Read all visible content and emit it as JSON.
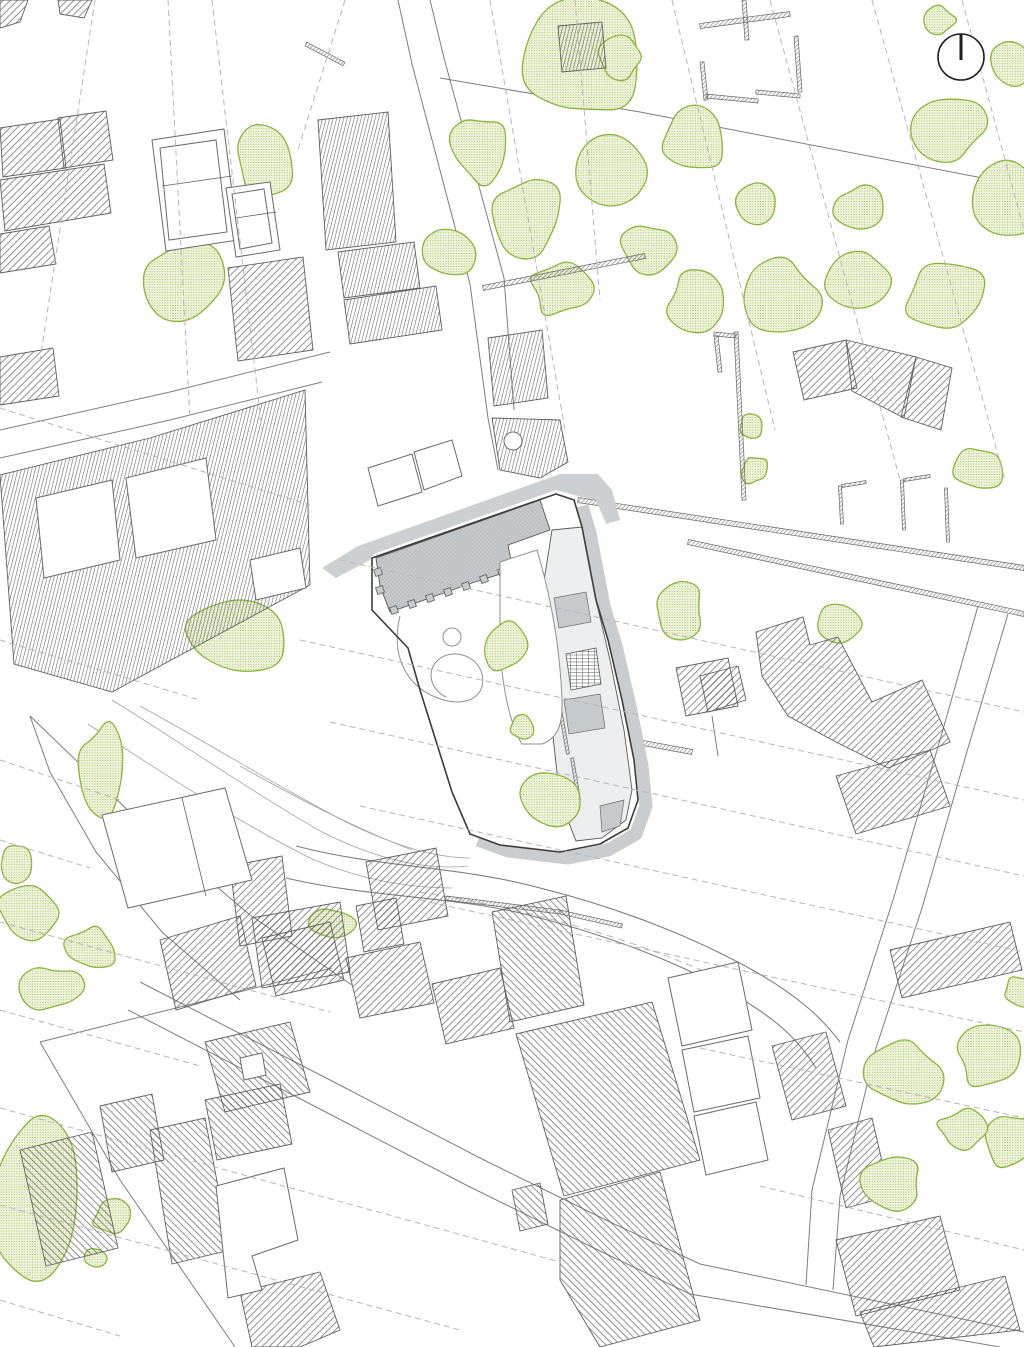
{
  "drawing": {
    "kind": "architectural-site-plan",
    "canvas": {
      "width": 1024,
      "height": 1347
    },
    "colors": {
      "line": "#5f5f5f",
      "outline": "#3c3c3c",
      "dash": "#b6b6b6",
      "parcel": "#7e7e7e",
      "terrain": "#a3a3a3",
      "greenline": "#8cb43d",
      "greendot": "#a6bf5e",
      "greenbg": "#eef3db",
      "plaza": "#ccd0d2",
      "shadow": "#c9cdcf",
      "paveb": "#c8ccce",
      "pavel": "#b2b6b8",
      "groom": "#c6cacc"
    },
    "north_arrow": {
      "icon": "north-arrow-icon",
      "cx": 961,
      "cy": 57,
      "r": 23
    },
    "contours_dashed": [
      "95,0 40,360",
      "168,0 190,420",
      "212,0 262,430",
      "345,0 298,150",
      "490,0 565,430",
      "575,0 600,300",
      "672,0 775,430",
      "770,0 900,480",
      "872,0 1005,480",
      "962,0 1024,230",
      "0,408 310,505",
      "0,640 200,700",
      "0,760 120,800",
      "0,840 90,868",
      "0,922 330,1012",
      "0,1010 200,1066",
      "0,1108 560,1262",
      "0,1205 460,1330",
      "0,1300 120,1336",
      "340,560 1024,712",
      "300,640 1024,800",
      "330,722 1024,876",
      "360,806 1024,952",
      "420,900 1024,1032",
      "700,1048 1024,1118",
      "760,1186 1024,1250"
    ],
    "terrain": [
      "M112,700 C180,742 252,792 322,832 C382,862 430,870 468,866",
      "M140,706 C210,744 280,788 350,824 C400,848 440,858 470,858",
      "M88,724 C160,772 235,820 310,858 C360,880 410,888 452,888",
      "M240,766 C300,800 360,830 412,850"
    ],
    "roads": {
      "upper": "M296,846 C380,868 460,866 540,888 C620,908 696,938 756,972 C798,996 822,1018 840,1042",
      "lower": "M286,878 C370,898 458,896 532,916 C610,936 684,964 740,998 C780,1022 800,1042 816,1068",
      "center_dash": "M420,892 C520,908 620,934 710,974"
    },
    "streets": [
      "398,0 412,64 470,284 488,418 498,470",
      "430,0 444,58 504,278 514,410",
      "440,78 640,112 1024,186",
      "0,430 170,392 330,352",
      "0,458 170,420 322,382",
      "30,716 138,820 250,915 352,985",
      "30,716 50,772 96,852 162,932 240,1000",
      "40,1042 200,1002 332,968",
      "40,1042 120,1180 235,1347",
      "978,606 940,740 893,900 848,1040 812,1190 806,1285",
      "1008,614 968,748 922,908 876,1048 840,1196 833,1290",
      "140,982 330,1080 480,1158 610,1222 700,1264 1024,1332",
      "128,1010 318,1108 468,1186 598,1250 690,1294 1000,1347"
    ],
    "detail_lines": [
      "162,186 232,176",
      "236,218 276,212",
      "182,798 206,896",
      "712,716 718,756"
    ],
    "walls": [
      [
        578,
        500,
        1024,
        568,
        5
      ],
      [
        688,
        542,
        1024,
        614,
        5
      ],
      [
        483,
        288,
        645,
        256,
        5
      ],
      [
        446,
        898,
        560,
        912,
        4
      ],
      [
        560,
        912,
        622,
        926,
        4
      ],
      [
        627,
        740,
        692,
        752,
        5
      ],
      [
        700,
        26,
        790,
        14,
        5
      ],
      [
        744,
        0,
        747,
        40,
        4
      ],
      [
        796,
        36,
        800,
        92,
        4
      ],
      [
        756,
        92,
        800,
        96,
        4
      ],
      [
        702,
        62,
        706,
        100,
        4
      ],
      [
        706,
        96,
        758,
        101,
        4
      ],
      [
        736,
        332,
        744,
        500,
        4
      ],
      [
        714,
        334,
        736,
        336,
        4
      ],
      [
        716,
        336,
        720,
        372,
        4
      ],
      [
        840,
        486,
        842,
        524,
        3
      ],
      [
        842,
        486,
        866,
        482,
        3
      ],
      [
        902,
        480,
        904,
        530,
        3
      ],
      [
        904,
        480,
        930,
        476,
        3
      ],
      [
        946,
        488,
        948,
        542,
        3
      ],
      [
        306,
        44,
        344,
        64,
        4
      ],
      [
        436,
        678,
        452,
        720,
        4
      ],
      [
        447,
        724,
        462,
        764,
        4
      ],
      [
        428,
        642,
        440,
        674,
        3
      ]
    ],
    "buildings": {
      "hatch_a": [
        "0,0 28,0 20,22 0,28",
        "58,0 92,0 84,18 60,14",
        "0,128 60,119 66,168 3,177",
        "58,118 106,111 113,160 64,168",
        "0,180 104,164 111,213 5,231",
        "0,234 49,226 56,264 0,273",
        "0,357 53,348 59,396 0,405",
        "228,268 303,257 313,350 238,361",
        "793,352 846,340 857,388 804,400",
        "846,340 916,357 904,418 852,391",
        "916,357 952,368 941,430 901,417",
        "756,632 803,617 810,645 838,637 872,702 922,680 950,742 888,768 836,742 788,716 762,676",
        "836,776 930,750 950,806 856,834",
        "700,676 738,666 746,700 708,712",
        "676,668 728,658 738,706 686,716",
        "366,862 436,848 448,916 378,930",
        "356,906 396,898 404,944 364,952",
        "230,866 282,856 292,936 240,946",
        "252,918 340,902 350,972 262,988",
        "160,940 240,916 256,986 176,1010",
        "262,938 330,922 344,980 276,996",
        "346,958 420,942 434,1003 360,1018",
        "432,984 500,968 514,1028 446,1044",
        "772,1046 826,1032 846,1106 792,1120",
        "828,1130 872,1118 890,1196 846,1208",
        "836,1240 940,1216 960,1290 856,1316",
        "890,950 1010,922 1022,970 902,998",
        "860,1312 1005,1276 1020,1330 874,1347",
        "240,1292 320,1272 340,1330 300,1347 252,1347"
      ],
      "hatch_b": [
        "492,912 566,896 584,1005 510,1022",
        "516,1034 652,1002 700,1160 564,1196",
        "560,1200 660,1172 700,1320 600,1347 560,1280",
        "512,1190 540,1183 548,1224 520,1231",
        "205,1042 290,1022 310,1092 225,1112",
        "205,1100 280,1084 292,1144 217,1160",
        "150,1130 205,1118 230,1250 172,1264",
        "20,1150 92,1132 118,1248 46,1266",
        "100,1106 152,1094 164,1160 112,1172"
      ],
      "hatch_v": [
        "318,120 388,112 396,242 326,250",
        "338,252 414,242 420,288 344,298",
        "344,300 436,286 442,330 350,344",
        "558,26 602,22 606,68 562,72",
        "488,338 542,330 548,398 494,406"
      ],
      "white": [
        "152,140 224,129 238,240 166,251",
        "226,188 270,182 280,250 236,257",
        "368,468 412,454 422,492 378,506",
        "414,452 452,440 462,476 424,490",
        "216,1186 284,1168 298,1240 252,1256 262,1290 228,1298",
        "102,815 225,788 252,880 128,908",
        "668,978 738,962 752,1030 682,1046",
        "682,1050 748,1036 760,1098 694,1112",
        "694,1116 756,1102 768,1160 706,1175",
        "240,1058 262,1053 266,1075 244,1080"
      ],
      "white_inner": [
        "160,148 216,140 227,232 169,240",
        "232,194 264,189 272,243 240,249"
      ],
      "block": {
        "outline": "0,475 150,438 305,390 310,585 112,692 14,664",
        "courtyards": [
          "36,498 112,480 120,560 44,578",
          "126,478 206,458 216,540 136,558",
          "250,560 300,548 306,588 256,600"
        ]
      },
      "chapel": {
        "poly": "492,418 560,420 568,462 540,478 500,470",
        "circle": [
          513,
          441,
          9
        ]
      }
    },
    "blobs": [
      [
        265,
        156,
        33,
        41,
        1
      ],
      [
        180,
        282,
        40,
        46,
        2
      ],
      [
        580,
        62,
        56,
        62,
        3
      ],
      [
        478,
        148,
        31,
        36,
        4
      ],
      [
        530,
        215,
        38,
        42,
        5
      ],
      [
        612,
        172,
        33,
        36,
        6
      ],
      [
        650,
        250,
        29,
        30,
        7
      ],
      [
        692,
        138,
        35,
        40,
        8
      ],
      [
        700,
        300,
        33,
        29,
        9
      ],
      [
        777,
        296,
        43,
        35,
        10
      ],
      [
        858,
        278,
        37,
        33,
        11
      ],
      [
        948,
        300,
        41,
        35,
        12
      ],
      [
        1002,
        206,
        35,
        41,
        13
      ],
      [
        948,
        126,
        39,
        33,
        14
      ],
      [
        860,
        206,
        25,
        23,
        15
      ],
      [
        757,
        206,
        23,
        21,
        16
      ],
      [
        448,
        252,
        25,
        28,
        17
      ],
      [
        562,
        288,
        33,
        29,
        18
      ],
      [
        622,
        58,
        23,
        21,
        19
      ],
      [
        1014,
        62,
        21,
        25,
        20
      ],
      [
        937,
        20,
        19,
        17,
        21
      ],
      [
        750,
        428,
        12,
        13,
        22
      ],
      [
        755,
        470,
        14,
        15,
        23
      ],
      [
        678,
        608,
        27,
        30,
        24
      ],
      [
        838,
        625,
        23,
        19,
        25
      ],
      [
        978,
        468,
        25,
        23,
        26
      ],
      [
        236,
        638,
        58,
        44,
        27
      ],
      [
        104,
        766,
        27,
        46,
        28
      ],
      [
        333,
        922,
        23,
        15,
        29
      ],
      [
        30,
        912,
        33,
        31,
        30
      ],
      [
        92,
        948,
        27,
        23,
        31
      ],
      [
        52,
        988,
        29,
        23,
        32
      ],
      [
        14,
        862,
        17,
        19,
        33
      ],
      [
        32,
        1196,
        50,
        84,
        34
      ],
      [
        114,
        1218,
        21,
        17,
        35
      ],
      [
        94,
        1258,
        12,
        11,
        36
      ],
      [
        902,
        1072,
        39,
        35,
        40
      ],
      [
        988,
        1058,
        33,
        29,
        41
      ],
      [
        1012,
        1142,
        27,
        29,
        42
      ],
      [
        962,
        1130,
        25,
        21,
        44
      ],
      [
        1020,
        992,
        19,
        17,
        45
      ]
    ],
    "blobs_top": [
      [
        506,
        646,
        23,
        27,
        37
      ],
      [
        523,
        727,
        12,
        11,
        38
      ],
      [
        553,
        798,
        37,
        29,
        39
      ],
      [
        893,
        1182,
        31,
        27,
        43
      ]
    ],
    "site": {
      "plaza": "322,568 358,546 560,474 598,474 612,490 620,520 606,524 596,500 578,496 556,490 374,554 370,560 336,578",
      "outline": "372,558 556,494 574,500 582,527 596,600 608,640 622,700 634,760 638,800 628,828 600,844 560,852 500,845 470,834 452,792 420,690 408,648 372,610",
      "shadow_path": "M574,500 L582,527 L596,600 L608,640 L622,700 L634,760 L638,800 L628,828 L600,844 L560,852 L500,845 L470,834",
      "shadow_offset": [
        8,
        6
      ],
      "courtyard": "376,558 540,500 550,530 508,545 513,570 472,583 390,612 380,586",
      "teeth": [
        [
          394,
          610
        ],
        [
          412,
          604
        ],
        [
          430,
          598
        ],
        [
          448,
          592
        ],
        [
          466,
          586
        ],
        [
          484,
          579
        ],
        [
          502,
          572
        ],
        [
          380,
          590
        ],
        [
          378,
          572
        ]
      ],
      "white_square": {
        "x": 512,
        "y": 564,
        "w": 15,
        "h": 15,
        "rot": -19
      },
      "garden_circle": [
        452,
        637,
        9
      ],
      "garden_loop": "M400,616 C390,658 408,690 444,700 C474,708 488,690 481,671 C475,655 452,648 438,660 C426,671 430,689 446,697",
      "bed": "M500,562 L537,550 C552,600 560,648 562,700 C563,724 558,738 542,744 L522,744 C510,724 503,690 500,650 Z",
      "east_strip": "552,530 582,527 596,600 610,660 624,730 632,790 626,820 602,838 576,841 560,800 549,700 541,600",
      "stair": "566,654 596,648 601,684 571,690",
      "gray_rooms": [
        "554,598 586,592 591,622 559,628",
        "564,700 600,694 605,728 569,734",
        "600,806 624,800 620,826 602,832"
      ],
      "ramps": [
        [
          560,
          708,
          568,
          754,
          3
        ],
        [
          572,
          758,
          579,
          800,
          3
        ]
      ]
    }
  }
}
